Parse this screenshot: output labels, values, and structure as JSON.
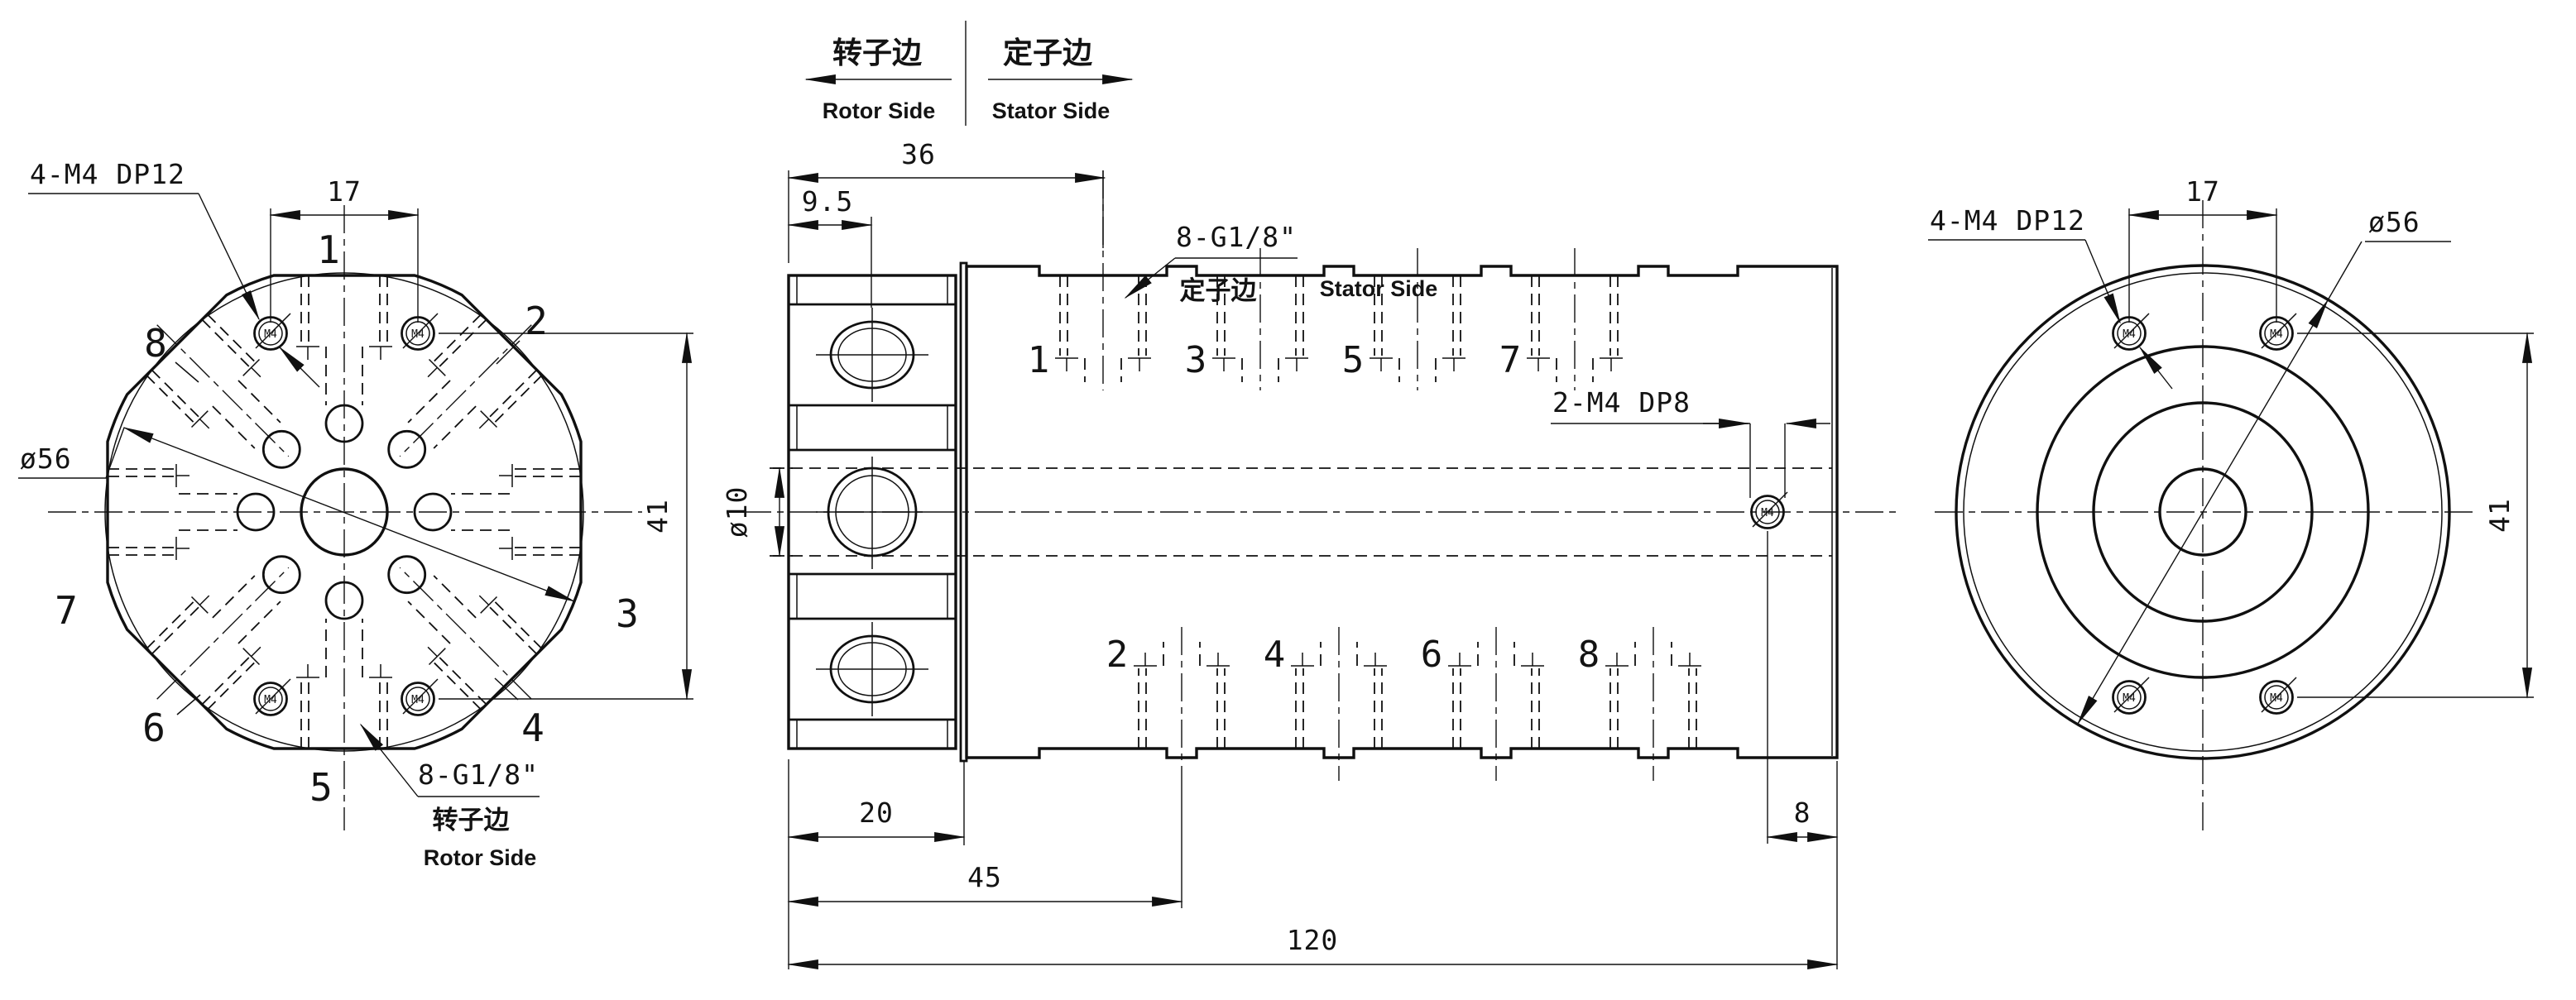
{
  "header": {
    "rotor_cn": "转子边",
    "rotor_en": "Rotor Side",
    "stator_cn": "定子边",
    "stator_en": "Stator Side"
  },
  "ports": [
    "1",
    "2",
    "3",
    "4",
    "5",
    "6",
    "7",
    "8"
  ],
  "dims": {
    "bolt_span": "17",
    "bolt_height": "41",
    "outer_dia": "ø56",
    "bore_dia": "ø10",
    "flange_port_offset": "9.5",
    "stator_port_start": "36",
    "rotor_length": "20",
    "port2_offset": "45",
    "total_length": "120",
    "end_tap_offset": "8"
  },
  "callouts": {
    "rotor_taps": "4-M4 DP12",
    "ports": "8-G1/8\"",
    "side_taps": "2-M4 DP8",
    "thread": "M4"
  },
  "side_labels": {
    "rotor_cn": "转子边",
    "rotor_en": "Rotor Side",
    "stator_cn": "定子边",
    "stator_en": "Stator Side"
  }
}
